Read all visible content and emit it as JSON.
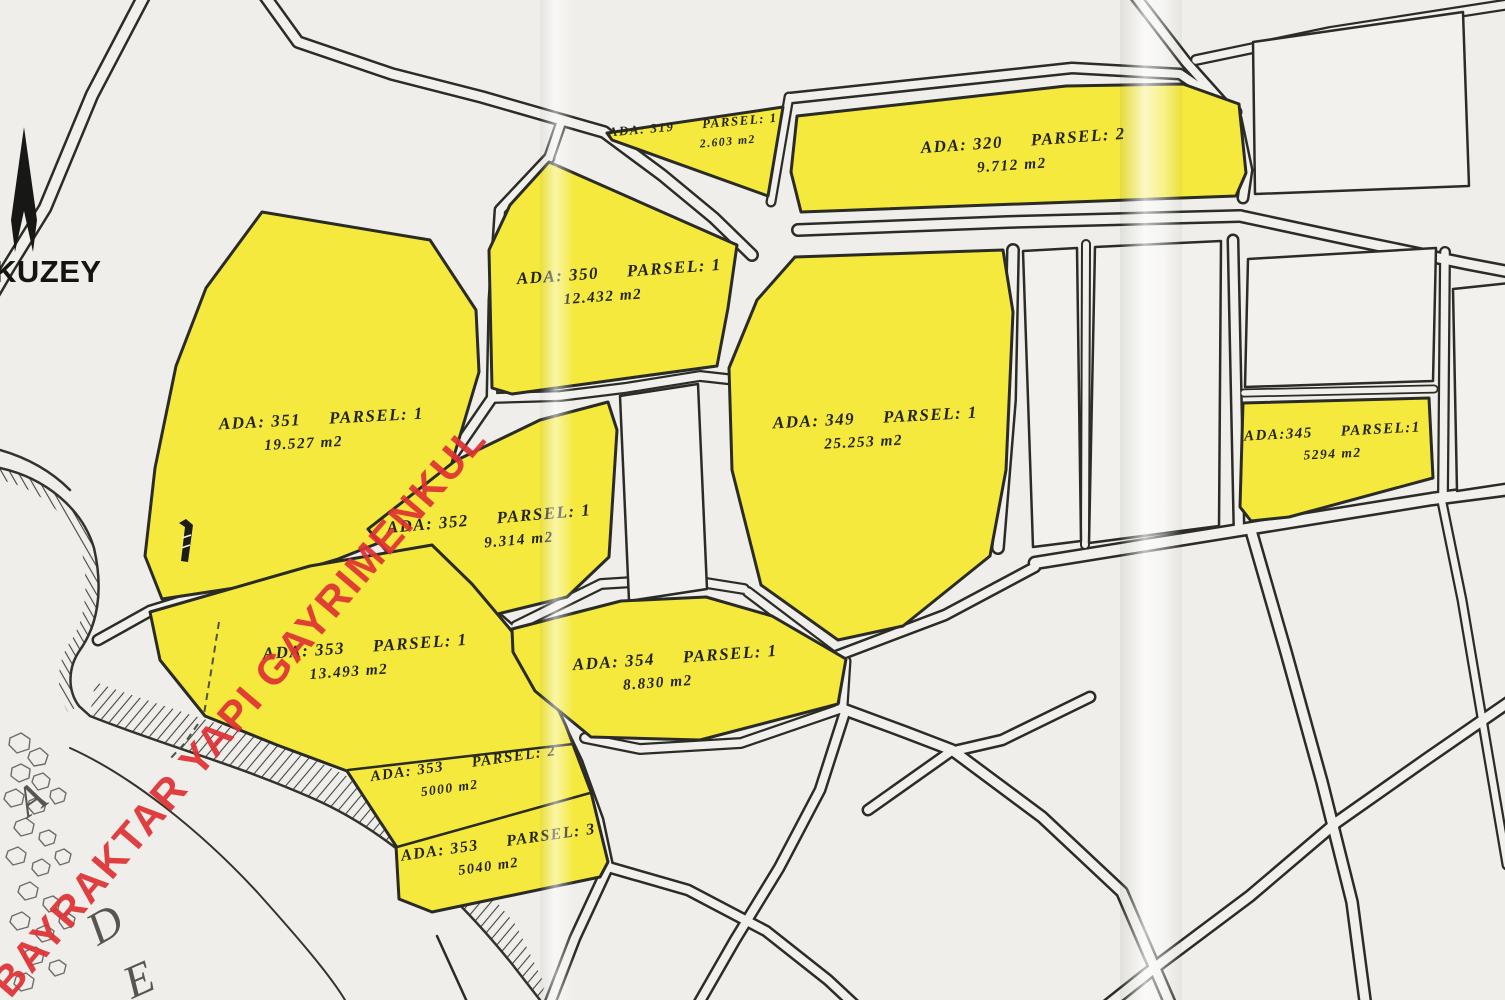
{
  "colors": {
    "highlight_yellow": "#f4e93c",
    "line_black": "#2c2c27",
    "paper": "#efeeea",
    "watermark_red": "#df3134",
    "letter_gray": "#56554e"
  },
  "compass": {
    "label": "KUZEY"
  },
  "watermark": {
    "text": "BAYRAKTAR YAPI GAYRIMENKUL"
  },
  "stream_letters": [
    "A",
    "D",
    "E"
  ],
  "icons": {
    "north_arrow": "north-arrow-icon",
    "tower_marker": "tower-marker-icon"
  },
  "parcels": [
    {
      "ada": "ADA: 319",
      "parsel": "PARSEL: 1",
      "area": "2.603 m2"
    },
    {
      "ada": "ADA: 320",
      "parsel": "PARSEL: 2",
      "area": "9.712 m2"
    },
    {
      "ada": "ADA: 350",
      "parsel": "PARSEL: 1",
      "area": "12.432 m2"
    },
    {
      "ada": "ADA: 351",
      "parsel": "PARSEL: 1",
      "area": "19.527 m2"
    },
    {
      "ada": "ADA: 349",
      "parsel": "PARSEL: 1",
      "area": "25.253 m2"
    },
    {
      "ada": "ADA:345",
      "parsel": "PARSEL:1",
      "area": "5294 m2"
    },
    {
      "ada": "ADA: 352",
      "parsel": "PARSEL: 1",
      "area": "9.314 m2"
    },
    {
      "ada": "ADA: 353",
      "parsel": "PARSEL: 1",
      "area": "13.493 m2"
    },
    {
      "ada": "ADA: 354",
      "parsel": "PARSEL: 1",
      "area": "8.830 m2"
    },
    {
      "ada": "ADA: 353",
      "parsel": "PARSEL: 2",
      "area": "5000 m2"
    },
    {
      "ada": "ADA: 353",
      "parsel": "PARSEL: 3",
      "area": "5040 m2"
    }
  ]
}
